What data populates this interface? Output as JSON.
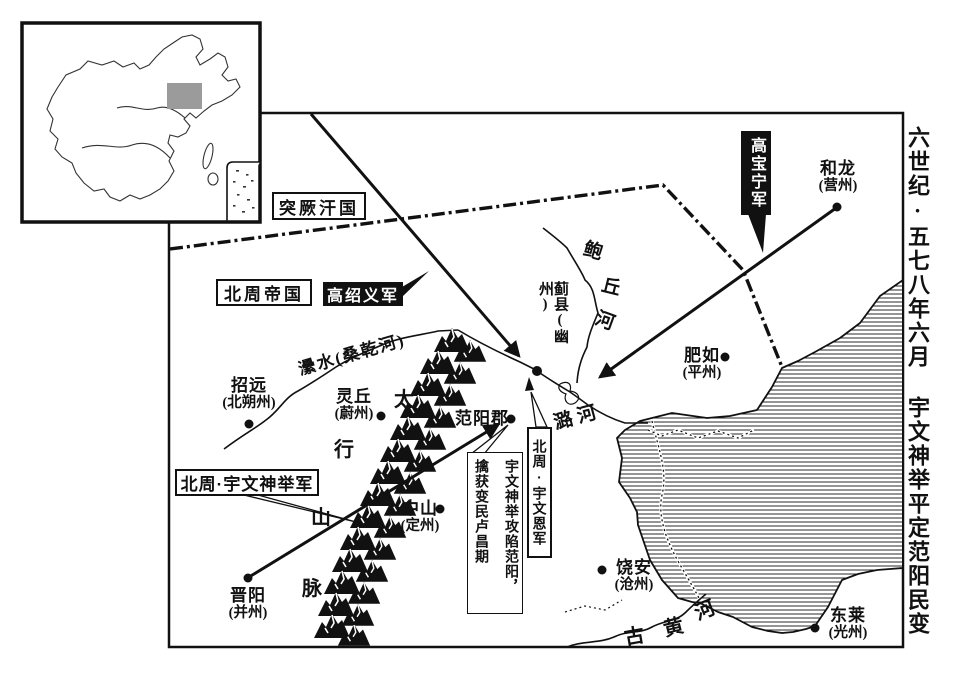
{
  "side_title": {
    "era": "六世纪·五七八年六月",
    "event": "宇文神举平定范阳民变"
  },
  "regions": {
    "turkic_khaganate": "突厥汗国",
    "northern_zhou_empire": "北周帝国"
  },
  "armies": {
    "gao_shaoyi": "高绍义军",
    "gao_baoning": "高宝宁军",
    "yuwen_shenju": "北周·宇文神举军",
    "yuwen_en": "北周·宇文恩军"
  },
  "annotation": {
    "col_right": "宇文神举攻陷范阳，",
    "col_left": "擒获变民卢昌期"
  },
  "cities": {
    "helong": {
      "name": "和龙",
      "sub": "(营州)"
    },
    "jixian": {
      "name": "蓟县(幽州)"
    },
    "feiru": {
      "name": "肥如",
      "sub": "(平州)"
    },
    "zhaoyuan": {
      "name": "招远",
      "sub": "(北朔州)"
    },
    "lingqiu": {
      "name": "灵丘",
      "sub": "(蔚州)"
    },
    "fanyang": {
      "name": "范阳郡"
    },
    "zhongshan": {
      "name": "中山",
      "sub": "(定州)"
    },
    "jinyang": {
      "name": "晋阳",
      "sub": "(并州)"
    },
    "raoan": {
      "name": "饶安",
      "sub": "(沧州)"
    },
    "donglai": {
      "name": "东莱",
      "sub": "(光州)"
    }
  },
  "rivers": {
    "baoqiu": [
      "鲍",
      "丘",
      "河"
    ],
    "luhe": "潞河",
    "leishui": "㶟水(桑乾河)",
    "old_yellow": [
      "古",
      "黄",
      "河"
    ]
  },
  "mountains": [
    "太",
    "行",
    "山",
    "脉"
  ],
  "colors": {
    "ink": "#111111",
    "paper": "#ffffff",
    "inset_highlight": "#9b9b9b"
  }
}
